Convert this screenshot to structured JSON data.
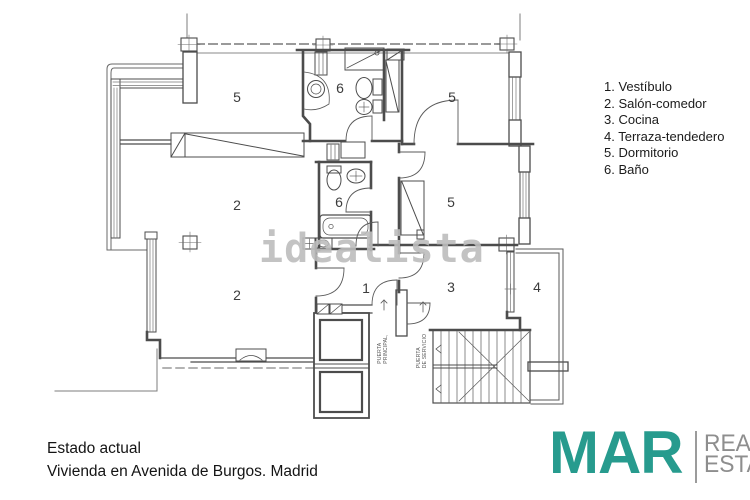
{
  "colors": {
    "logo_teal": "#279b8e",
    "logo_gray": "#8e8e8e",
    "watermark_gray": "#bdbdbd",
    "wall": "#4c4c4c"
  },
  "legend": {
    "items": [
      "1. Vestíbulo",
      "2. Salón-comedor",
      "3. Cocina",
      "4. Terraza-tendedero",
      "5. Dormitorio",
      "6. Baño"
    ]
  },
  "floor_plan": {
    "watermark": "idealista",
    "room_labels": [
      {
        "label": "5",
        "x": 237,
        "y": 97
      },
      {
        "label": "6",
        "x": 340,
        "y": 88
      },
      {
        "label": "5",
        "x": 452,
        "y": 97
      },
      {
        "label": "2",
        "x": 237,
        "y": 205
      },
      {
        "label": "6",
        "x": 339,
        "y": 202
      },
      {
        "label": "5",
        "x": 451,
        "y": 202
      },
      {
        "label": "2",
        "x": 237,
        "y": 295
      },
      {
        "label": "1",
        "x": 366,
        "y": 288
      },
      {
        "label": "3",
        "x": 451,
        "y": 287
      },
      {
        "label": "4",
        "x": 537,
        "y": 287
      }
    ],
    "annotations": [
      {
        "text": "PUERTA\nPRINCIPAL,",
        "x": 384,
        "y": 349
      },
      {
        "text": "PUERTA\nDE SERVICIO",
        "x": 423,
        "y": 351
      }
    ]
  },
  "footer": {
    "line1": "Estado actual",
    "line2": "Vivienda en Avenida de Burgos. Madrid"
  },
  "logo": {
    "name": "MAR",
    "tagline_line1": "REAL",
    "tagline_line2": "ESTATE"
  }
}
